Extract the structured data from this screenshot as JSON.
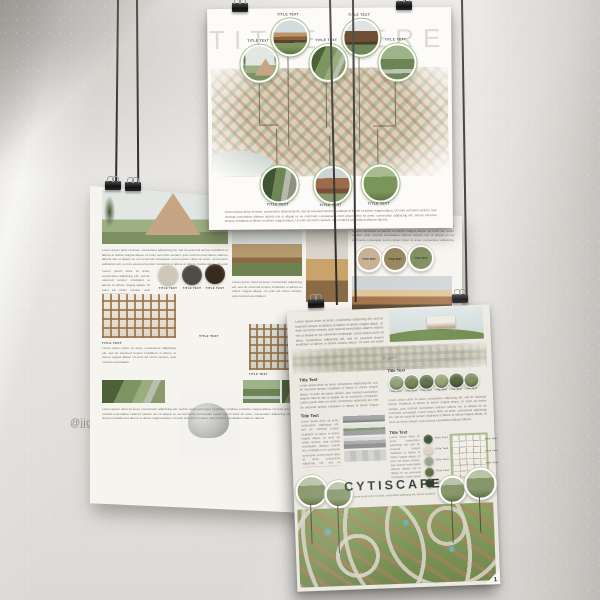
{
  "watermarks": {
    "wall_left": "@jjg",
    "wall_right": "ibs",
    "banner": "@jjgibs"
  },
  "shared": {
    "lorem": "Lorem ipsum dolor sit amet, consectetur adipiscing elit, sed do eiusmod tempor incididunt ut labore et dolore magna aliqua. Ut enim ad minim veniam, quis nostrud exercitation ullamco laboris nisi ut aliquip ex ea commodo consequat. Lorem ipsum dolor sit amet, consectetur adipiscing elit, sed do eiusmod tempor incididunt ut labore et dolore magna aliqua. Ut enim ad minim veniam, quis nostrud exercitation ullamco laboris.",
    "lorem_short": "Lorem ipsum dolor sit amet, consectetur adipiscing elit, sed do eiusmod tempor incididunt ut labore et dolore magna aliqua. Ut enim ad minim veniam, quis nostrud exercitation."
  },
  "poster_top": {
    "title": "TITLE HERE",
    "tile_label": "TITLE TEXT",
    "accent_green": "#a3bd85"
  },
  "poster_middle": {
    "tile_label": "TITLE TEXT",
    "swatches": [
      "#cfc7b8",
      "#4e4c49",
      "#392a1e"
    ],
    "circle_swatches": [
      "#c8b194",
      "#97865e",
      "#7e8c5a"
    ]
  },
  "poster_bottom": {
    "title": "CYTISCAPE",
    "subtitle": "Lorem ipsum dolor sit amet, consectetur adipiscing elit, sed do eiusmod",
    "heading": "Title Text",
    "tile_label": "Title Text",
    "page_number": "1",
    "swatches": [
      "#3f5036",
      "#dcd2bf",
      "#99a08c",
      "#5a6a41",
      "#2e3b27"
    ],
    "veg_circle_colors": [
      "#8a9a6a",
      "#6b7d4c",
      "#55693f",
      "#93a071",
      "#4d5f3a",
      "#7b8d5c"
    ]
  }
}
